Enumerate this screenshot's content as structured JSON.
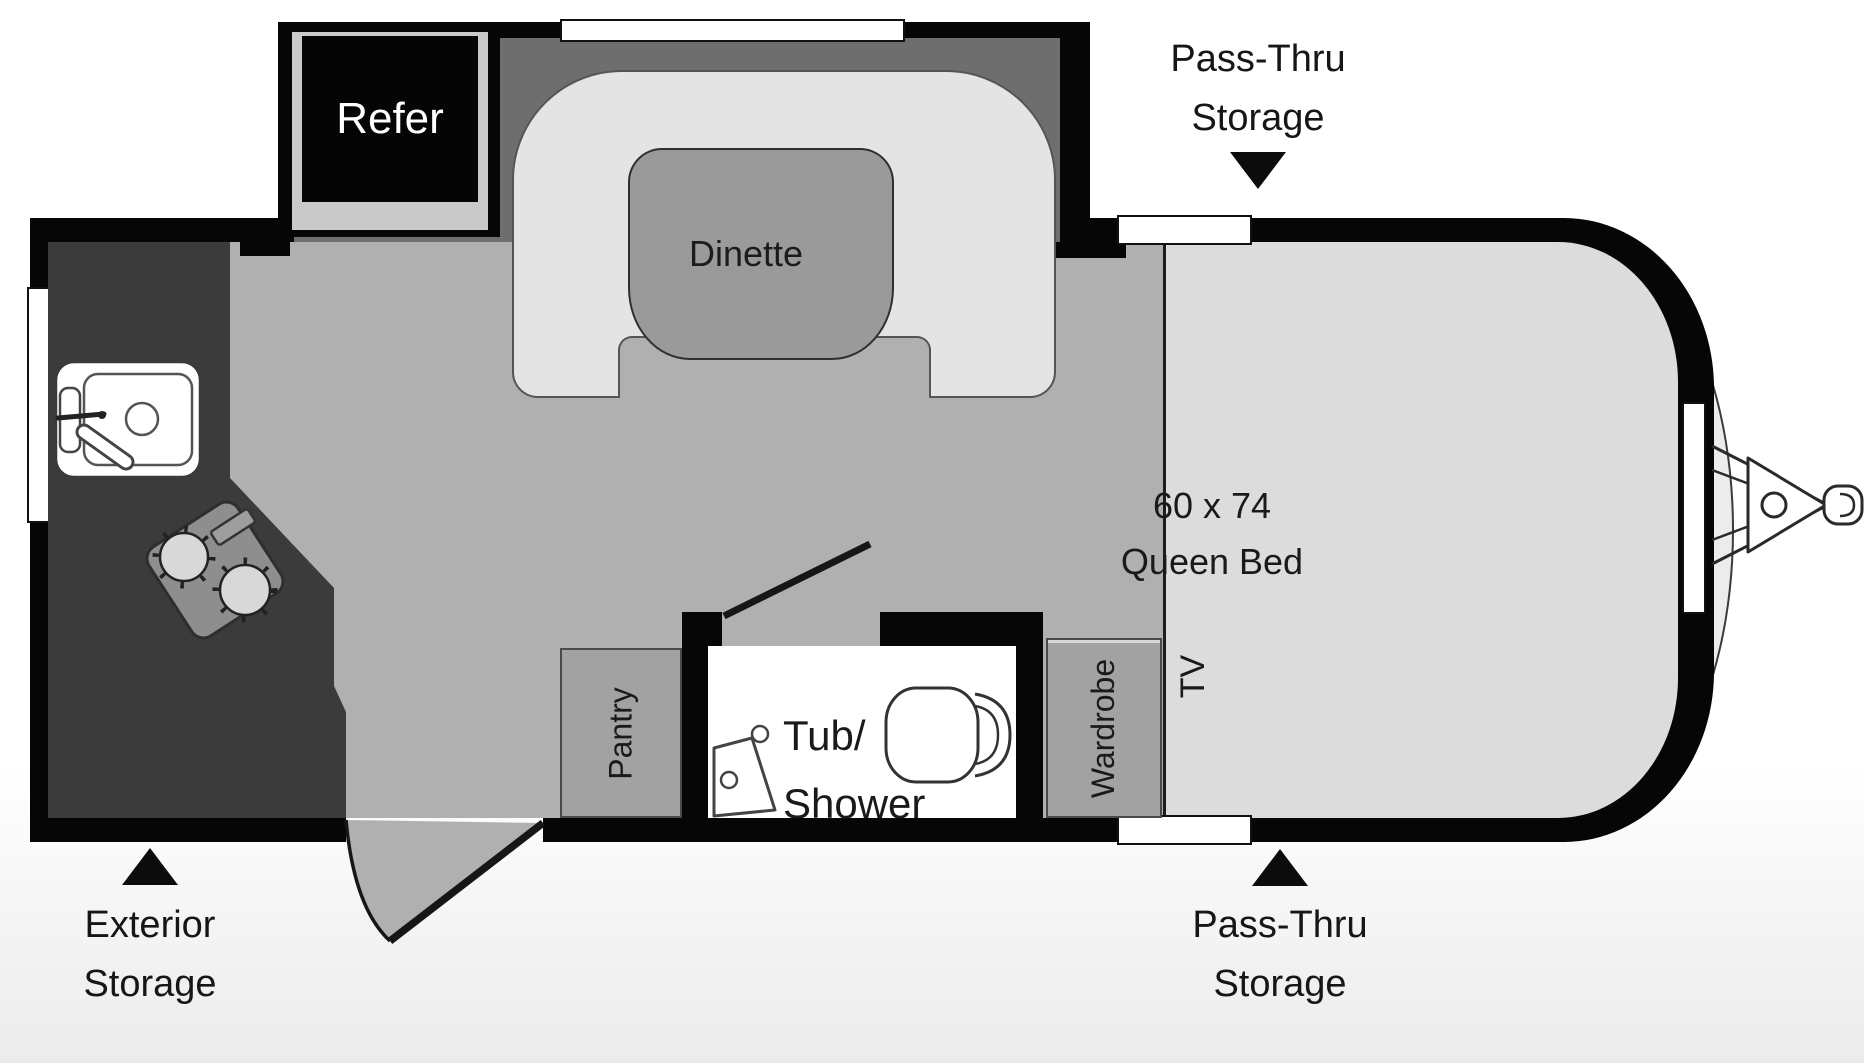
{
  "title": "Travel trailer floor plan",
  "colors": {
    "wall": "#060606",
    "floor_main": "#b0b0b0",
    "floor_bedroom": "#dcdcdc",
    "dinette_backdrop": "#6e6e6e",
    "bench": "#e4e4e4",
    "table": "#9a9a9a",
    "counter": "#3b3b3b",
    "cabinet": "#a2a2a2",
    "bathroom_floor": "#ffffff",
    "refer_box": "#050505",
    "refer_liner": "#c9c9c9",
    "body_skin": "#ececec"
  },
  "rooms": {
    "refer": "Refer",
    "dinette": "Dinette",
    "bed": {
      "line1": "60 x 74",
      "line2": "Queen Bed"
    },
    "tub_shower": {
      "line1": "Tub/",
      "line2": "Shower"
    },
    "pantry": "Pantry",
    "wardrobe": "Wardrobe",
    "tv": "TV"
  },
  "annotations": {
    "pass_thru_top": {
      "line1": "Pass-Thru",
      "line2": "Storage"
    },
    "pass_thru_bottom": {
      "line1": "Pass-Thru",
      "line2": "Storage"
    },
    "exterior_storage": {
      "line1": "Exterior",
      "line2": "Storage"
    }
  }
}
